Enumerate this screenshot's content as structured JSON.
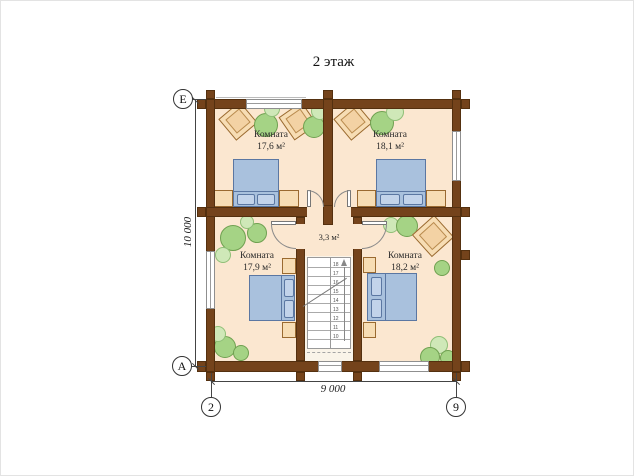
{
  "title": "2 этаж",
  "rooms": {
    "top_left": {
      "name": "Комната",
      "area": "17,6 м²"
    },
    "top_right": {
      "name": "Комната",
      "area": "18,1 м²"
    },
    "bottom_left": {
      "name": "Комната",
      "area": "17,9 м²"
    },
    "bottom_right": {
      "name": "Комната",
      "area": "18,2 м²"
    }
  },
  "hall": {
    "area": "3,3 м²"
  },
  "stairs": {
    "steps": [
      "18",
      "17",
      "16",
      "15",
      "14",
      "13",
      "12",
      "11",
      "10"
    ]
  },
  "dimensions": {
    "vertical": "10 000",
    "horizontal": "9 000"
  },
  "axis_markers": {
    "row_top": "Е",
    "row_bottom": "А",
    "col_left": "2",
    "col_right": "9"
  },
  "colors": {
    "wall": "#74431b",
    "floor": "#fbe7d0",
    "bed": "#a9c1dd",
    "furniture": "#f7ddb4",
    "plant_dark": "#a5d385",
    "plant_light": "#cfe8b8",
    "annotation": "#444444"
  }
}
